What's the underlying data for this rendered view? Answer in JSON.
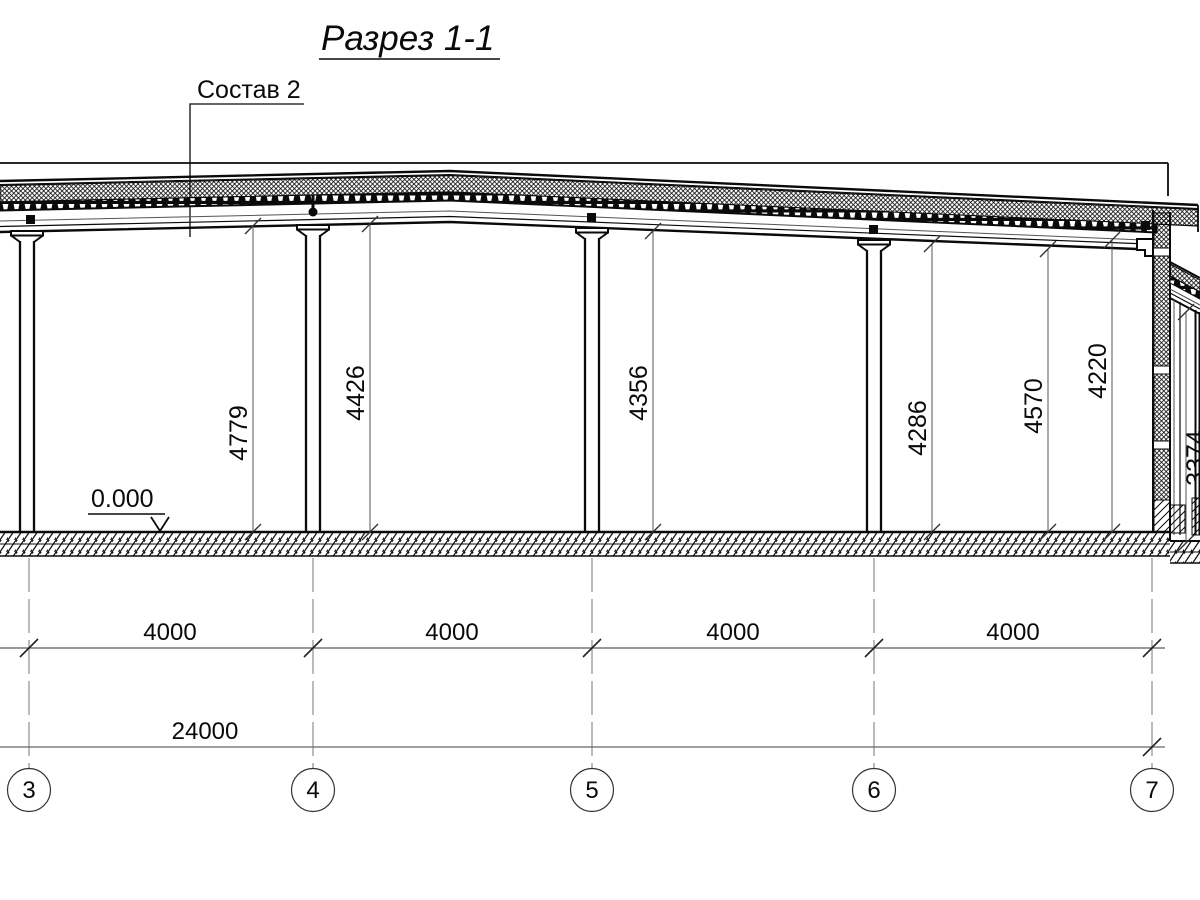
{
  "title": "Разрез 1-1",
  "callout_label": "Состав 2",
  "elevation_mark": "0.000",
  "height_dims": [
    "4779",
    "4426",
    "4356",
    "4286",
    "4570",
    "4220"
  ],
  "annex_height_dim": "3374",
  "span_dims": [
    "4000",
    "4000",
    "4000",
    "4000"
  ],
  "overall_dim": "24000",
  "axes": [
    "3",
    "4",
    "5",
    "6",
    "7"
  ],
  "colors": {
    "line": "#0a0a0a",
    "thin_line": "#555555",
    "grid_line": "#777777",
    "background": "#ffffff"
  }
}
